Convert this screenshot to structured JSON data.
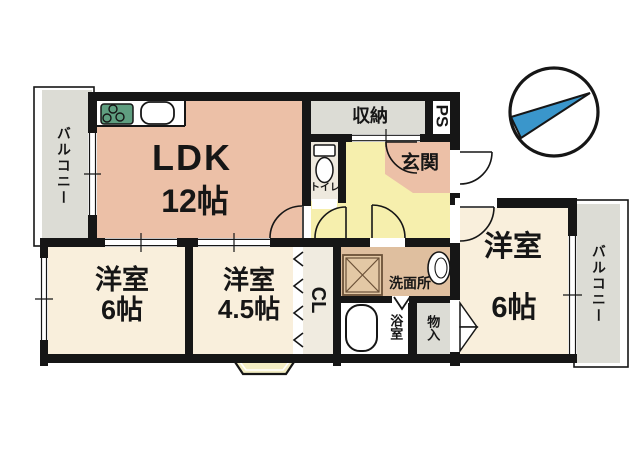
{
  "rooms": {
    "balcony_left": {
      "label": "バルコニー"
    },
    "ldk": {
      "label": "LDK",
      "size": "12帖"
    },
    "storage": {
      "label": "収納"
    },
    "ps": {
      "label": "PS"
    },
    "toilet": {
      "label": "トイレ"
    },
    "genkan": {
      "label": "玄関"
    },
    "bedroom_left": {
      "label": "洋室",
      "size": "6帖"
    },
    "bedroom_center": {
      "label": "洋室",
      "size": "4.5帖"
    },
    "closet": {
      "label": "CL"
    },
    "washroom": {
      "label": "洗面所"
    },
    "bathroom": {
      "label": "浴室"
    },
    "storage_small": {
      "label": "物入"
    },
    "bedroom_right": {
      "label": "洋室",
      "size": "6帖"
    },
    "balcony_right": {
      "label": "バルコニー"
    }
  },
  "icons": {
    "compass": "compass-north-arrow",
    "stove": "stove-burners",
    "sink": "kitchen-sink",
    "toilet": "toilet",
    "bathtub": "bathtub",
    "washer": "washing-machine-pan",
    "basin": "wash-basin"
  },
  "colors": {
    "room_salmon": "#ecc0a7",
    "hall_yellow": "#f6efad",
    "bedroom_cream": "#f9efdc",
    "washroom_tan": "#dfbf9f",
    "toilet_beige": "#eee9de",
    "closet_white": "#f0ebe0",
    "gray": "#dcdcd5",
    "bath_white": "#ffffff",
    "wall_black": "#161616",
    "compass_blue": "#3a96cb",
    "step_yellow": "#f3edc3",
    "stove_green": "#5f9e80"
  }
}
